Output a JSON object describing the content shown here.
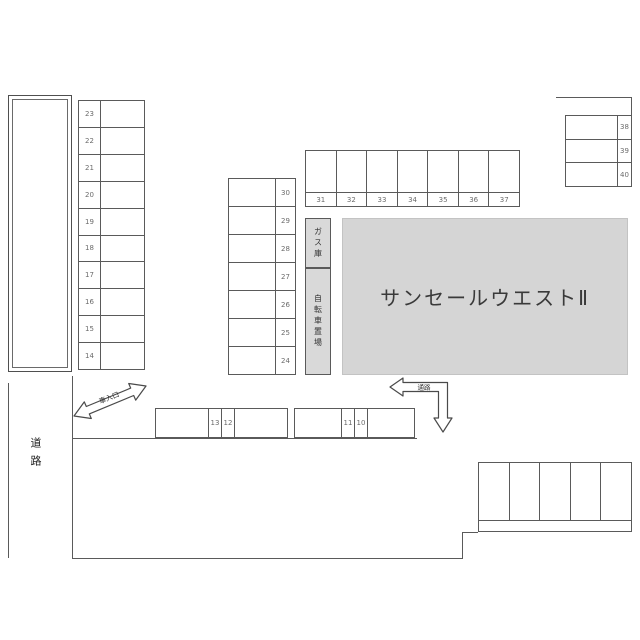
{
  "title": "サンセールウエストⅡ",
  "labels": {
    "gas_storage": "ガス庫",
    "bicycle_parking": "自転車置場",
    "road": "道路",
    "car_entrance": "車入口",
    "aisle": "通路"
  },
  "stalls": {
    "left_column_top_to_bottom": [
      "23",
      "22",
      "21",
      "20",
      "19",
      "18",
      "17",
      "16",
      "15",
      "14"
    ],
    "middle_column_top_to_bottom": [
      "30",
      "29",
      "28",
      "27",
      "26",
      "25",
      "24"
    ],
    "top_row_left_to_right": [
      "31",
      "32",
      "33",
      "34",
      "35",
      "36",
      "37"
    ],
    "right_column_top_to_bottom": [
      "38",
      "39",
      "40"
    ],
    "bottom_row_left_pair": [
      "13",
      "12"
    ],
    "bottom_row_right_pair": [
      "11",
      "10"
    ],
    "unnumbered_block_stall_count": 5
  },
  "colors": {
    "line": "#5a5a5a",
    "building_fill": "#d5d5d5",
    "annex_fill": "#d9d9d9",
    "stall_number": "#6b6b6b",
    "title_text": "#3a3a3a"
  }
}
